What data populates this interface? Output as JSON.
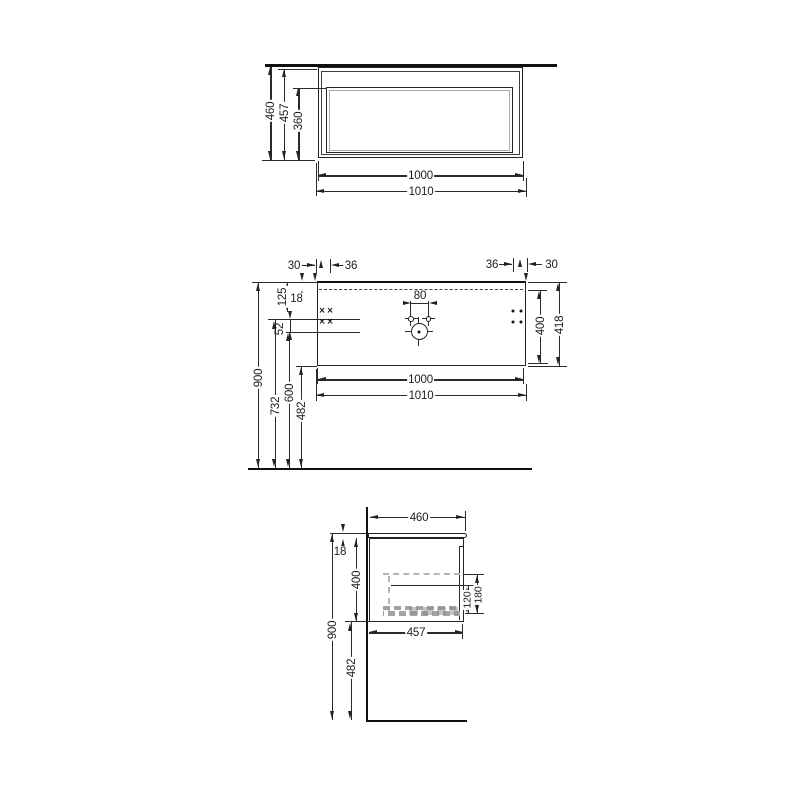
{
  "drawing": {
    "colors": {
      "line": "#2b2b2b",
      "heavy_line": "#101010",
      "light_gray": "#b4b4b4"
    },
    "front_view": {
      "total_height": "460",
      "carcass_height": "457",
      "drawer_front_height": "360",
      "carcass_width": "1000",
      "worktop_width": "1010"
    },
    "plan_view": {
      "left_edge_offset": "30",
      "left_hole_spacing": "36",
      "right_hole_spacing": "36",
      "right_edge_offset": "30",
      "top_inset": "18",
      "hole_row_offset": "125",
      "hole_row_gap": "52",
      "tap_hole_spacing": "80",
      "inner_depth": "400",
      "total_depth": "418",
      "carcass_width": "1000",
      "worktop_width": "1010",
      "worktop_height": "900",
      "upper_fixing_height": "732",
      "lower_fixing_height": "600",
      "underside_clearance": "482"
    },
    "side_view": {
      "total_depth": "460",
      "worktop_thickness": "18",
      "carcass_height": "400",
      "worktop_height": "900",
      "underside_clearance": "482",
      "drain_clearance_min": "120",
      "drain_clearance_max": "180",
      "carcass_depth": "457"
    }
  }
}
